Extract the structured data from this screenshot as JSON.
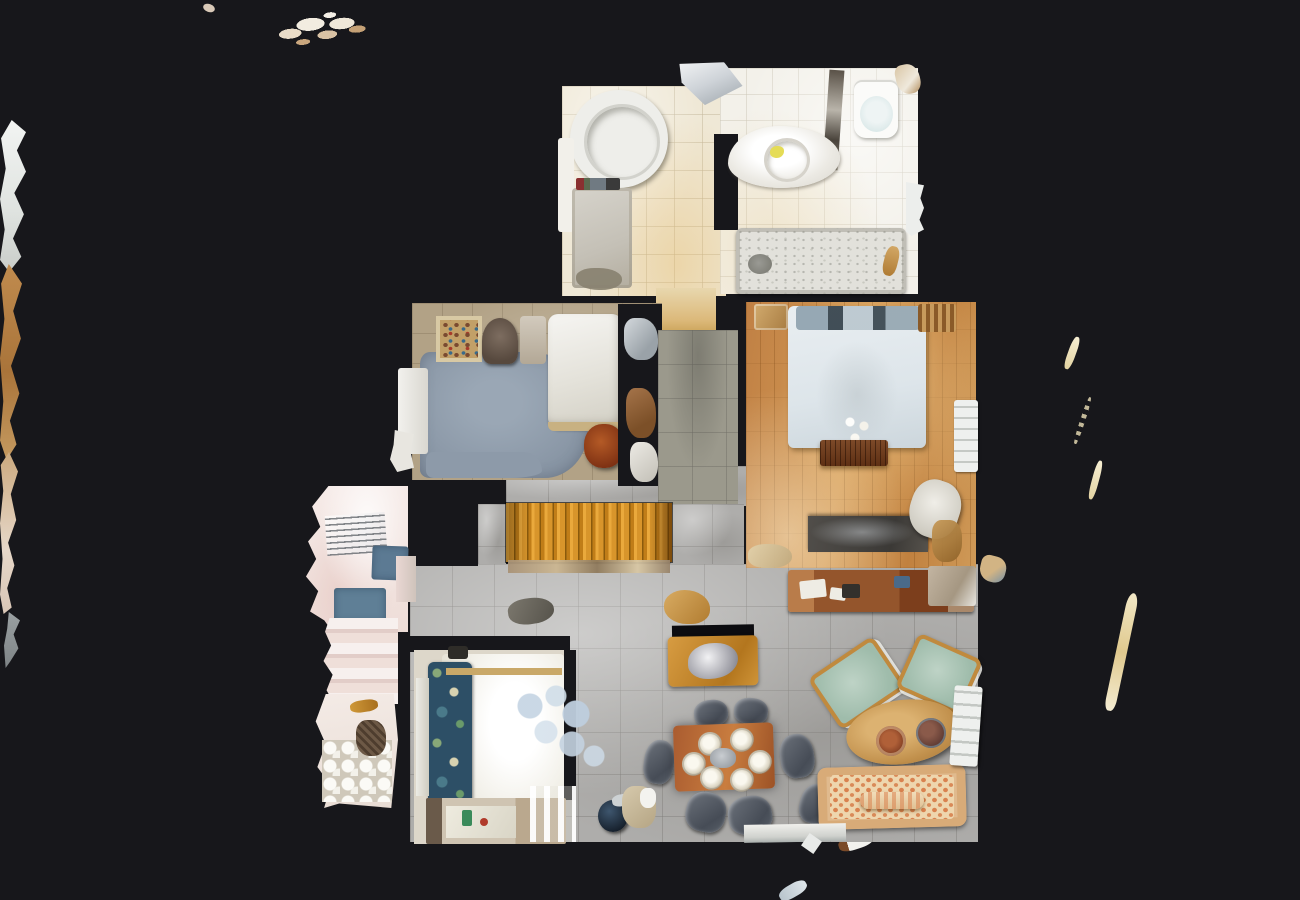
{
  "scene": {
    "type": "3d-dollhouse-floor-plan-scan",
    "view": "top-down aerial view of a scanned apartment floor",
    "background_color": "#17171b",
    "rooms": {
      "bathroom_main": {
        "label": "Main bathroom with round jacuzzi tub and bath mat",
        "floor_color": "#efe8d6"
      },
      "bathroom_second": {
        "label": "Second bathroom with vanity sink, toilet and terrazzo bathtub",
        "floor_color": "#f3f1ea"
      },
      "bedroom": {
        "label": "Master bedroom with double bed on oak parquet",
        "floor_color": "#c98f4c"
      },
      "study": {
        "label": "Study with blue-grey rug, shelf, armchair and white daybed",
        "rug_color": "#8d9aa9",
        "floor_color": "#b2a286"
      },
      "landing": {
        "label": "Hallway landing with grey-green tiles",
        "floor_color": "#9b998c"
      },
      "staircase": {
        "label": "Orange wooden staircase",
        "wood_color": "#d8952b",
        "tread_count": 13
      },
      "laundry_wing": {
        "label": "Left wing with drying rack, blue mats and cobble tiles",
        "floor_color": "#f6ebe8",
        "mat_color": "#5c7a93"
      },
      "guest_bedroom": {
        "label": "Lower bedroom with bright white bed and floral throw",
        "floral_color": "#2d4f66"
      },
      "living_dining": {
        "label": "Open living and dining area on large grey tiles",
        "floor_color": "#aeadab"
      }
    },
    "furniture": {
      "jacuzzi": {
        "label": "Round jacuzzi tub",
        "color": "#eeeeea"
      },
      "vanity": {
        "label": "Bathroom vanity with round sink and yellow soap",
        "color": "#ffffff"
      },
      "toilet": {
        "label": "Toilet with pale blue seat",
        "seat_color": "#d4e6e6"
      },
      "bathtub": {
        "label": "Bathtub with speckled terrazzo base",
        "color": "#e2e1db"
      },
      "bed": {
        "label": "Double bed with pale blue duvet and dark pillows",
        "duvet_color": "#dde5ea"
      },
      "bench": {
        "label": "Slatted wooden bench at foot of bed",
        "color": "#5e3014"
      },
      "bedroom_desk": {
        "label": "Dark desk with laptop",
        "color": "#3b3936"
      },
      "daybed": {
        "label": "White daybed",
        "color": "#f6f5f2"
      },
      "bookshelf": {
        "label": "Shelf with colourful items seen from above",
        "color": "#c2a068"
      },
      "sideboard": {
        "label": "Long reddish-wood sideboard with papers",
        "color": "#94552c"
      },
      "console_table": {
        "label": "Console table with silver decor",
        "color": "#d79c42"
      },
      "dining_table": {
        "label": "Dining table set with six white plates",
        "color": "#c97d3f",
        "place_settings": 6
      },
      "dining_chairs": {
        "label": "Grey dining chairs",
        "count": 7,
        "color": "#565b64"
      },
      "armchairs": {
        "label": "Pale-green armchairs with wooden frames",
        "count": 2,
        "seat_color": "#9fbcab"
      },
      "coffee_table": {
        "label": "Oval wooden coffee table with two bowls",
        "color": "#c1904c"
      },
      "sofa": {
        "label": "Cream sofa with orange dot pattern and bolster cushion",
        "base_color": "#e0ba8e",
        "dot_color": "#d9824f"
      },
      "pendant": {
        "label": "Pale blue glass pendant lamp seen from above",
        "color": "#c7d6e4"
      },
      "dresser": {
        "label": "Dresser with framed pictures and ornaments",
        "color": "#cfc4b2"
      },
      "teapot": {
        "label": "Dark blue teapot on floor",
        "color": "#16202c"
      },
      "drying_rack": {
        "label": "Clothes drying rack",
        "color": "#888d92"
      },
      "radiators": {
        "label": "White wall radiators",
        "count": 2,
        "color": "#eef0ee"
      }
    },
    "artifacts": {
      "label": "Torn 3D-scan mesh debris at image edges",
      "color": "#d9c4a6"
    }
  }
}
